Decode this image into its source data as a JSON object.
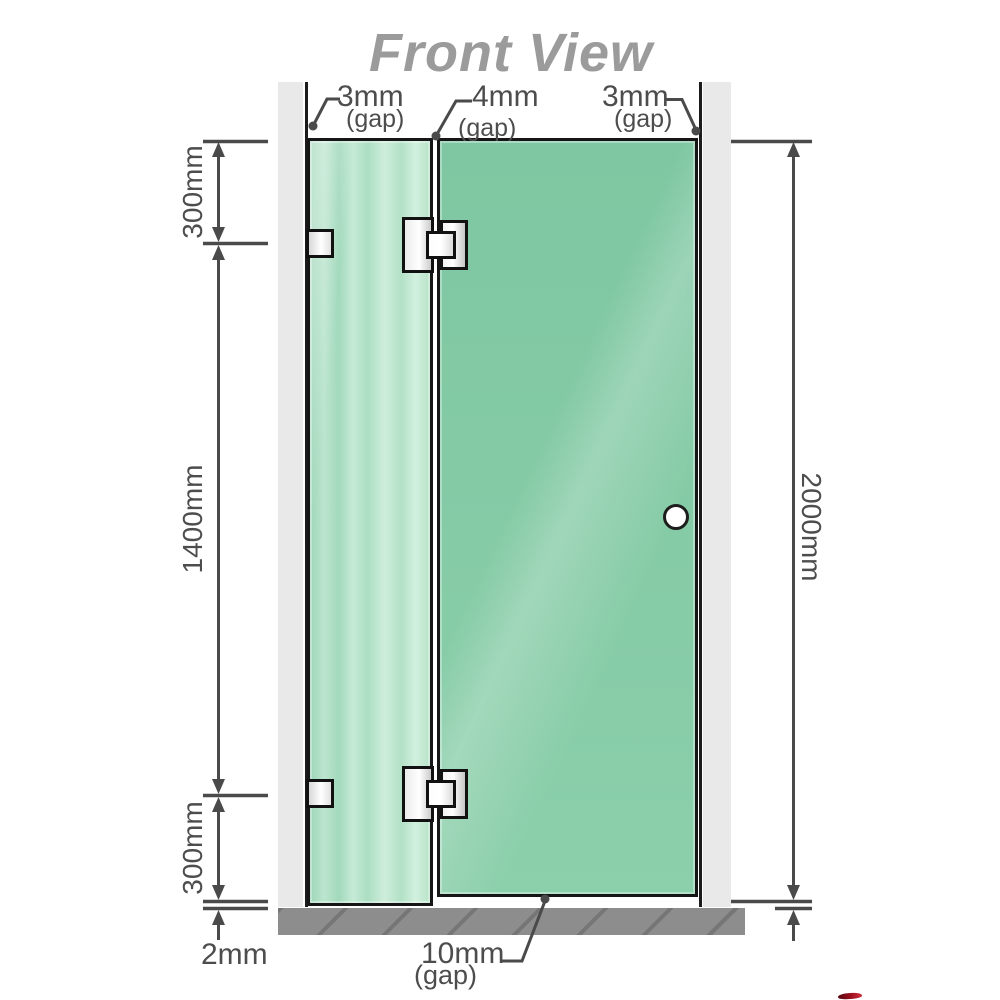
{
  "title": "Front View",
  "labels": {
    "gap_top_left": {
      "value": "3mm",
      "unit": "(gap)"
    },
    "gap_top_center": {
      "value": "4mm",
      "unit": "(gap)"
    },
    "gap_top_right": {
      "value": "3mm",
      "unit": "(gap)"
    },
    "gap_bottom": {
      "value": "10mm",
      "unit": "(gap)"
    },
    "segment_top": "300mm",
    "segment_middle": "1400mm",
    "segment_bottom": "300mm",
    "total_height": "2000mm",
    "floor_gap": "2mm"
  },
  "colors": {
    "title_text": "#9b9b9b",
    "dimension_text": "#4d4d4d",
    "dimension_lines": "#4a4a4a",
    "glass_fixed_panel": "#b2e1c6",
    "glass_door_panel": "#85cba6",
    "wall": "#e9e9e9",
    "floor": "#8d8d8d",
    "hardware_metal": "#ececec",
    "outline": "#161616",
    "corner_mark_red": "#a0101f"
  }
}
